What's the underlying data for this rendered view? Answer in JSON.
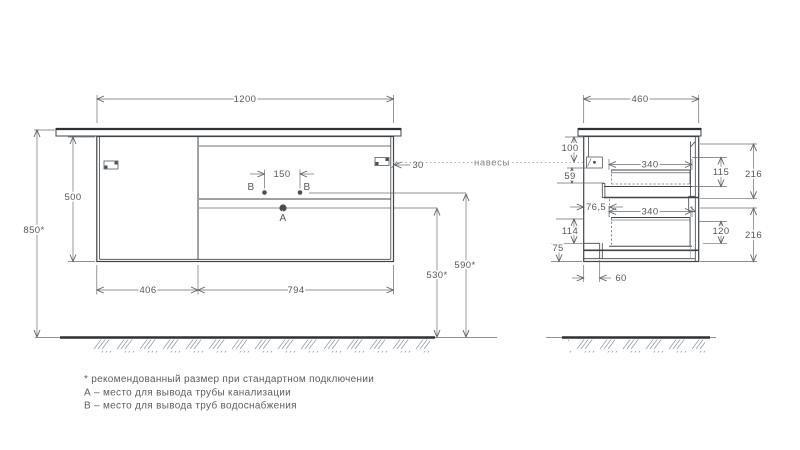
{
  "front_view": {
    "width": "1200",
    "height": "500",
    "mounting_height": "850*",
    "door_width": "406",
    "drawers_width": "794",
    "b_points_spacing": "150",
    "hanger_side_offset": "30",
    "drain_outlet_height": "530*",
    "water_supply_height": "590*",
    "point_a": "А",
    "point_b": "В"
  },
  "side_view": {
    "depth": "460",
    "top_to_hangers": "100",
    "hangers_to_drawer": "59",
    "back_clearance": "76,5",
    "lower_back_height": "114",
    "bottom_rail_height": "75",
    "bottom_back_offset": "60",
    "upper_drawer_depth": "340",
    "lower_drawer_depth": "340",
    "upper_drawer_inner_height": "115",
    "lower_drawer_inner_height": "120",
    "upper_front_height": "216",
    "lower_front_height": "216"
  },
  "labels": {
    "hangers": "навесы"
  },
  "footnotes": {
    "recommended": "* рекомендованный размер при стандартном подключении",
    "point_a": "А – место для вывода трубы канализации",
    "point_b": "В – место для вывода труб водоснабжения"
  },
  "colors": {
    "line": "#3f4347",
    "dimension": "#686d72",
    "text": "#55585c"
  }
}
